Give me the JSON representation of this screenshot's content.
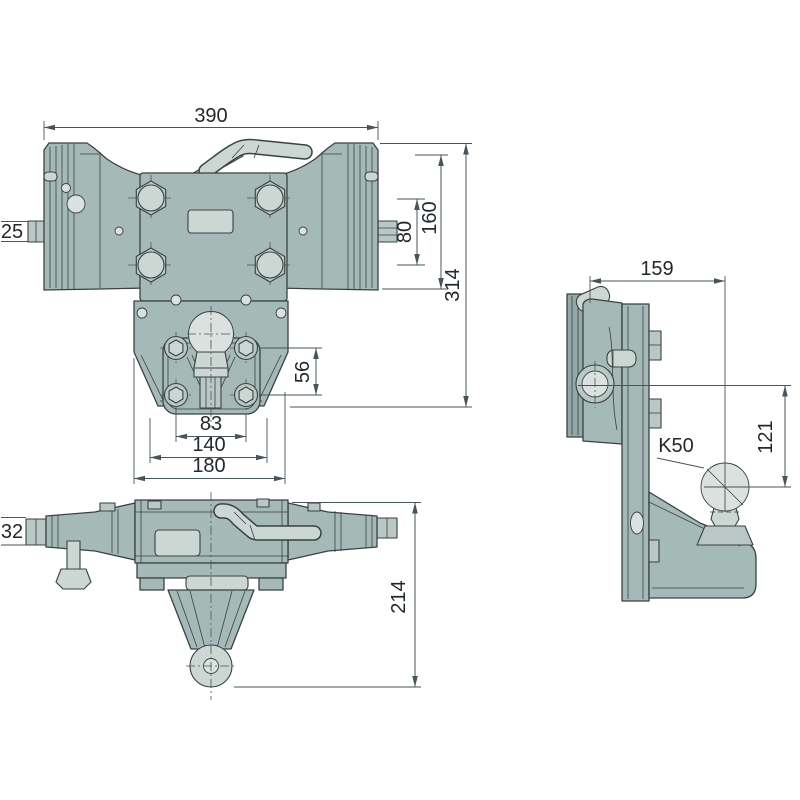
{
  "colors": {
    "background": "#ffffff",
    "body": "#a5bab6",
    "body_dark": "#93a9a5",
    "body_mid": "#b9c8c4",
    "body_light": "#ccd6d2",
    "highlight": "#dae1de",
    "outline": "#3a4143",
    "dimension_line": "#47545a",
    "text": "#23282a"
  },
  "views": {
    "front": {
      "dims": {
        "overall_width": "390",
        "pin": "25",
        "bolt_spacing": "80",
        "end_plate_height": "160",
        "total_height": "314",
        "flange_bolt_spacing_v": "56",
        "flange_bolt_spacing_h": "83",
        "flange_width": "140",
        "base_width": "180"
      }
    },
    "plan": {
      "dims": {
        "pin": "32",
        "depth": "214"
      }
    },
    "side": {
      "dims": {
        "width": "159",
        "ball_drop": "121"
      },
      "ball_label": "K50"
    }
  }
}
